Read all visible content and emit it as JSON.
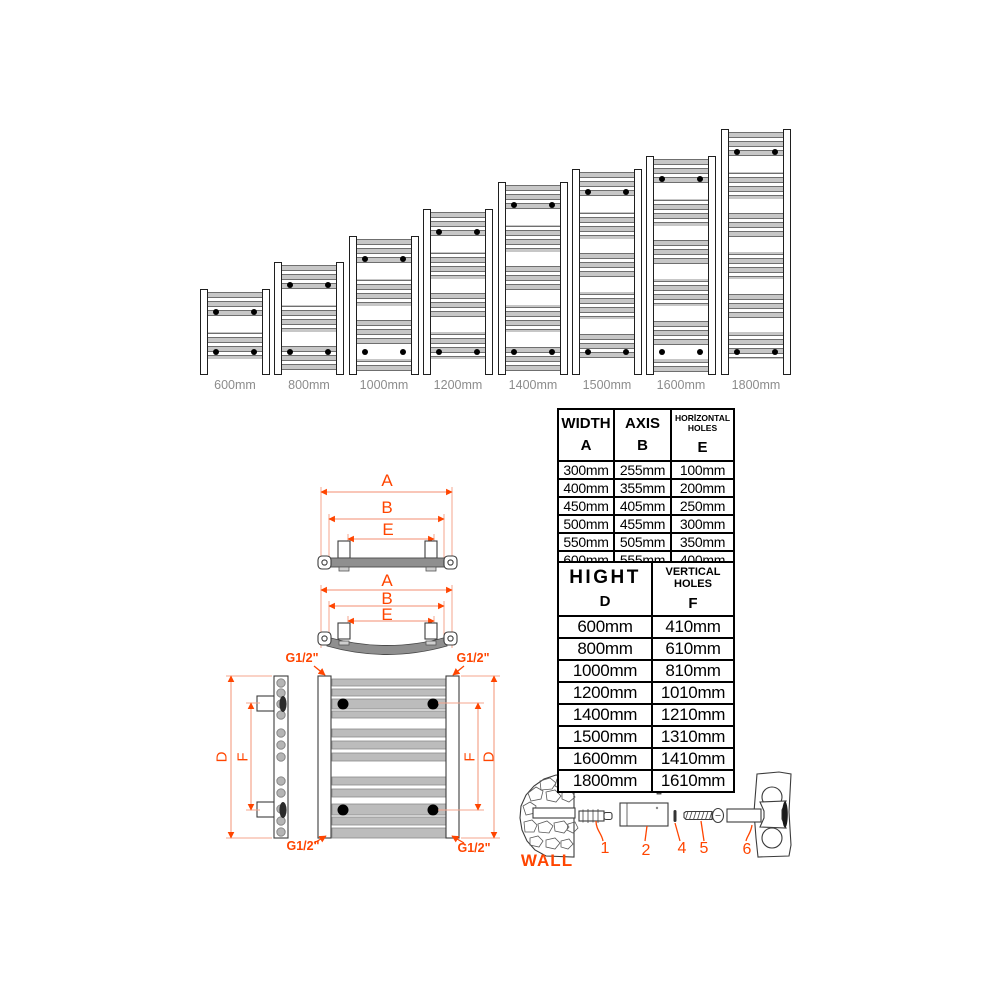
{
  "colors": {
    "accent": "#FF4500",
    "dim_line": "#F5A58D",
    "bar_gray": "#8F8F8F",
    "size_label_gray": "#8C8C8C"
  },
  "size_lineup": {
    "items": [
      {
        "label": "600mm",
        "height_mm": 600
      },
      {
        "label": "800mm",
        "height_mm": 800
      },
      {
        "label": "1000mm",
        "height_mm": 1000
      },
      {
        "label": "1200mm",
        "height_mm": 1200
      },
      {
        "label": "1400mm",
        "height_mm": 1400
      },
      {
        "label": "1500mm",
        "height_mm": 1500
      },
      {
        "label": "1600mm",
        "height_mm": 1600
      },
      {
        "label": "1800mm",
        "height_mm": 1800
      }
    ]
  },
  "top_view_straight": {
    "dim_a": "A",
    "dim_b": "B",
    "dim_e": "E"
  },
  "top_view_curved": {
    "dim_a": "A",
    "dim_b": "B",
    "dim_e": "E"
  },
  "front_view": {
    "dim_d": "D",
    "dim_f": "F"
  },
  "connection_thread": "G1/2\"",
  "width_table": {
    "col1_title": "WIDTH",
    "col1_letter": "A",
    "col2_title": "AXIS",
    "col2_letter": "B",
    "col3_title_line1": "HORİZONTAL",
    "col3_title_line2": "HOLES",
    "col3_letter": "E",
    "rows": [
      [
        "300mm",
        "255mm",
        "100mm"
      ],
      [
        "400mm",
        "355mm",
        "200mm"
      ],
      [
        "450mm",
        "405mm",
        "250mm"
      ],
      [
        "500mm",
        "455mm",
        "300mm"
      ],
      [
        "550mm",
        "505mm",
        "350mm"
      ],
      [
        "600mm",
        "555mm",
        "400mm"
      ]
    ]
  },
  "height_table": {
    "col1_title": "HIGHT",
    "col1_letter": "D",
    "col2_title_line1": "VERTICAL",
    "col2_title_line2": "HOLES",
    "col2_letter": "F",
    "rows": [
      [
        "600mm",
        "410mm"
      ],
      [
        "800mm",
        "610mm"
      ],
      [
        "1000mm",
        "810mm"
      ],
      [
        "1200mm",
        "1010mm"
      ],
      [
        "1400mm",
        "1210mm"
      ],
      [
        "1500mm",
        "1310mm"
      ],
      [
        "1600mm",
        "1410mm"
      ],
      [
        "1800mm",
        "1610mm"
      ]
    ]
  },
  "mounting": {
    "wall_label": "WALL",
    "parts": [
      "1",
      "2",
      "3",
      "4",
      "5",
      "6"
    ]
  }
}
